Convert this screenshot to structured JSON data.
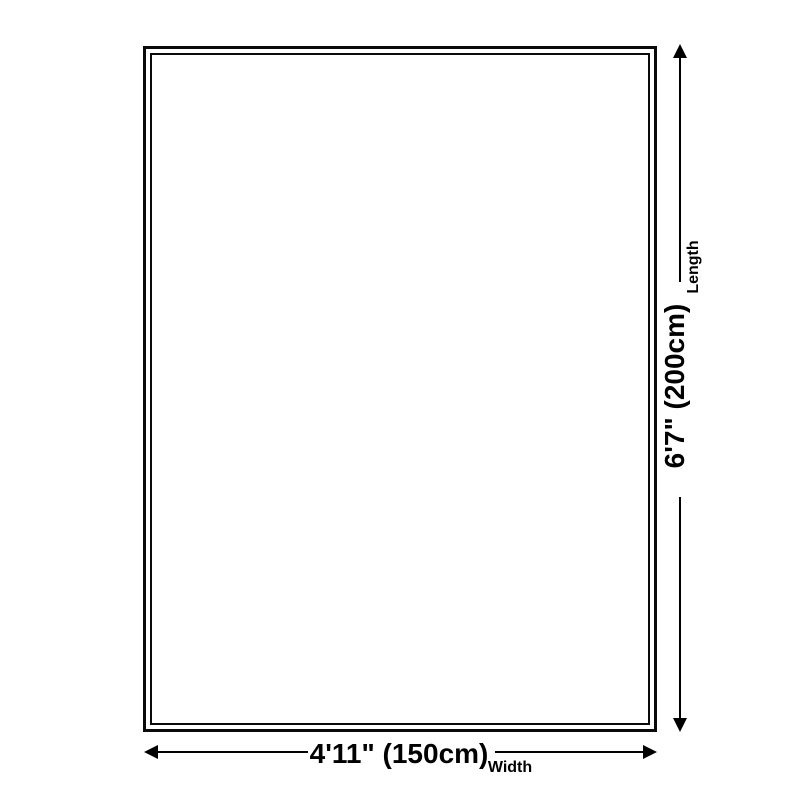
{
  "dimension_diagram": {
    "length": {
      "value": "6'7\" (200cm)",
      "label": "Length"
    },
    "width": {
      "value": "4'11\" (150cm)",
      "label": "Width"
    },
    "colors": {
      "line": "#000000",
      "outline_border": "#0a0a0a",
      "background": "#ffffff"
    },
    "icons": {
      "arrow_up": "arrow-up-icon",
      "arrow_down": "arrow-down-icon",
      "arrow_left": "arrow-left-icon",
      "arrow_right": "arrow-right-icon"
    }
  }
}
